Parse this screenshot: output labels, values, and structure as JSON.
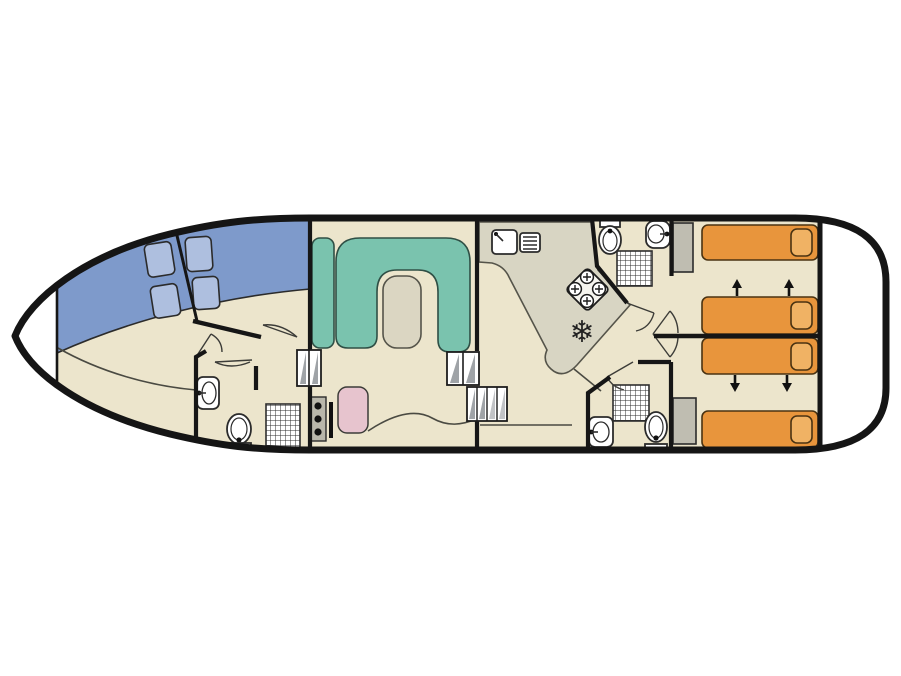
{
  "diagram": {
    "type": "boat-floor-plan",
    "icons": {
      "freezer_snowflake": "❄"
    },
    "inventory": {
      "single_beds": 4,
      "pillows": 4,
      "bathrooms": 3,
      "showers": 3,
      "toilets": 3,
      "bathroom_sinks": 3,
      "galley_burners": 4,
      "bed_convert_arrows": 4,
      "window_hatches": 4,
      "wardrobes": 2,
      "step_flights": 3
    }
  },
  "colors": {
    "background": "#ffffff",
    "hull_outline": "#151515",
    "floor": "#ece5cc",
    "deck_white": "#ffffff",
    "window_band": "#7e9acb",
    "window_hatch": "#aebfdf",
    "sofa": "#7ac3ae",
    "sofa_edge": "#2f4f45",
    "table": "#dbd6c2",
    "counter": "#d8d5c3",
    "bed": "#e8953c",
    "pillow": "#f0b264",
    "helm_seat": "#e7c4ce",
    "wardrobe": "#bfbdb1",
    "wall": "#161616",
    "step_shade": "#9fa3a7",
    "stove_panel": "#f5f4ee"
  }
}
